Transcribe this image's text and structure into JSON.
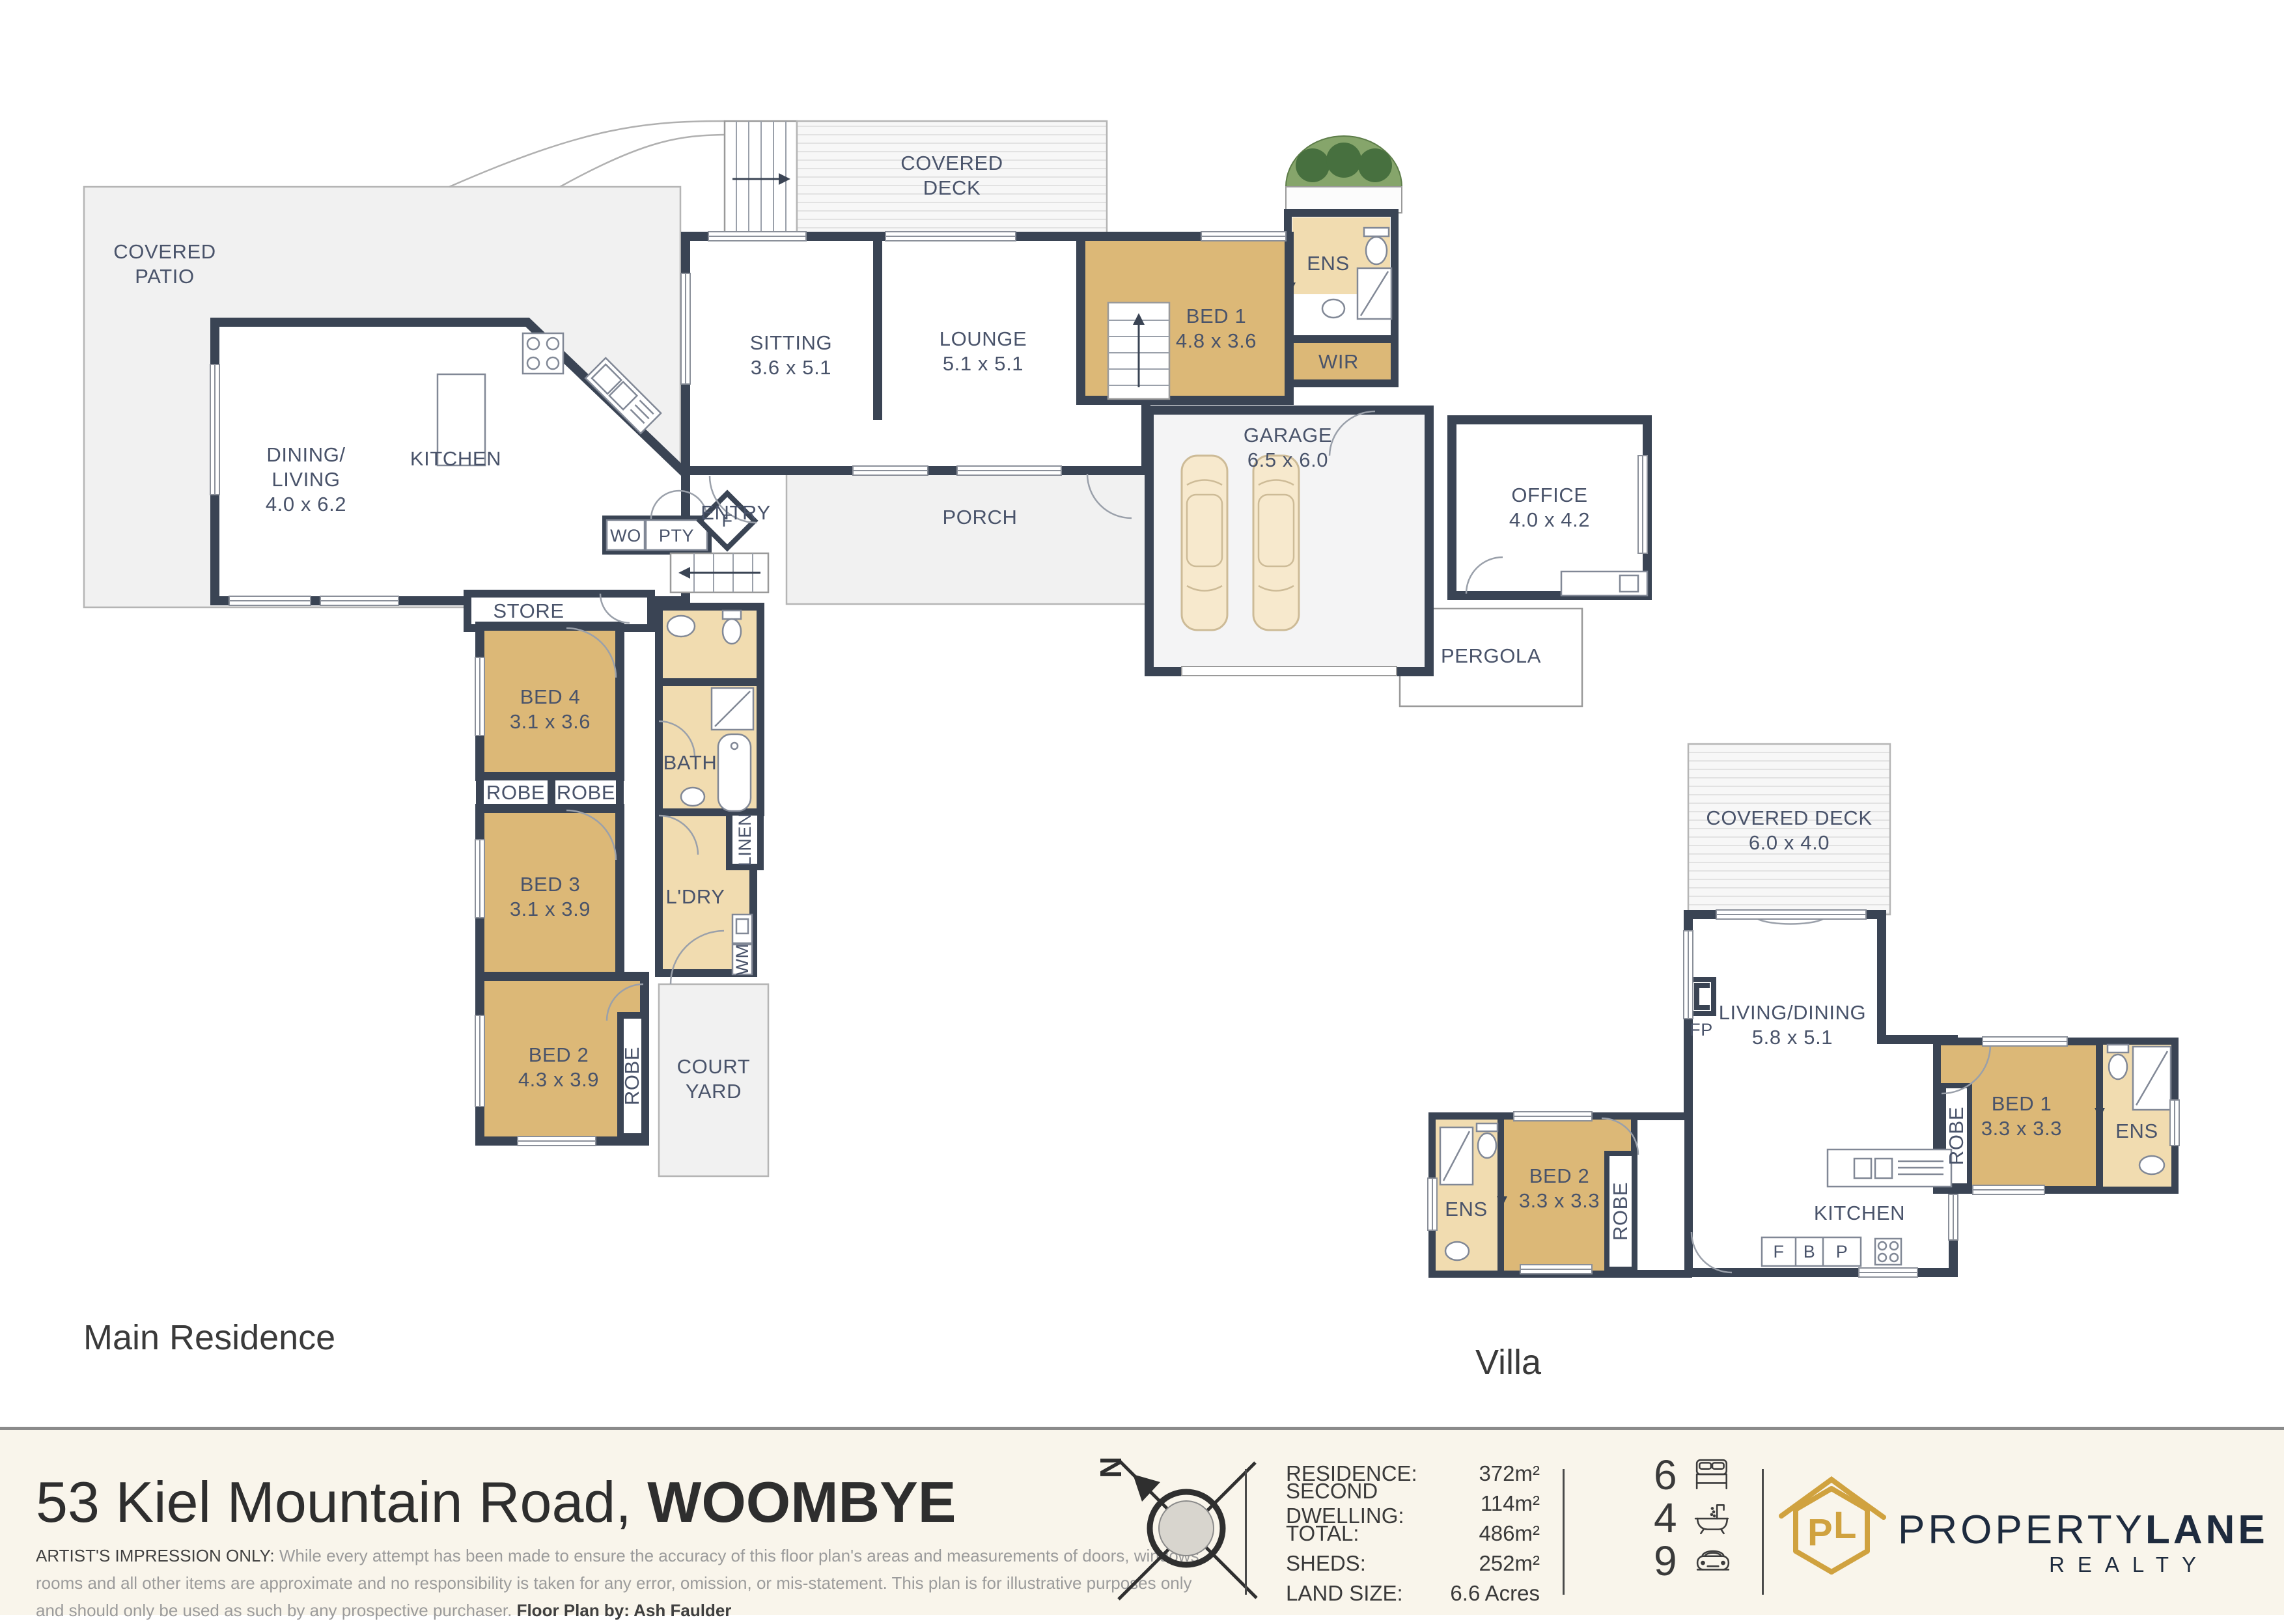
{
  "colors": {
    "wall": "#3a4454",
    "bedroom": "#dcb877",
    "wet_area": "#f1dcb0",
    "outdoor": "#f1f1f1",
    "brand_gold": "#d0a23f",
    "brand_navy": "#1e2b3e",
    "footer_bg": "#f9f5eb"
  },
  "main": {
    "label": "Main Residence",
    "rooms": {
      "patio": {
        "l1": "COVERED",
        "l2": "PATIO"
      },
      "deck": {
        "l1": "COVERED",
        "l2": "DECK"
      },
      "sitting": {
        "name": "SITTING",
        "dims": "3.6 x 5.1"
      },
      "lounge": {
        "name": "LOUNGE",
        "dims": "5.1 x 5.1"
      },
      "bed1": {
        "name": "BED 1",
        "dims": "4.8 x 3.6"
      },
      "ens": {
        "name": "ENS"
      },
      "wir": {
        "name": "WIR"
      },
      "garage": {
        "name": "GARAGE",
        "dims": "6.5 x 6.0"
      },
      "office": {
        "name": "OFFICE",
        "dims": "4.0 x 4.2"
      },
      "pergola": {
        "name": "PERGOLA"
      },
      "dining": {
        "l1": "DINING/",
        "l2": "LIVING",
        "dims": "4.0 x 6.2"
      },
      "kitchen": {
        "name": "KITCHEN"
      },
      "entry": {
        "name": "ENTRY"
      },
      "porch": {
        "name": "PORCH"
      },
      "wo": {
        "name": "WO"
      },
      "pty": {
        "name": "PTY"
      },
      "fridge": {
        "name": "F"
      },
      "store": {
        "name": "STORE"
      },
      "bed4": {
        "name": "BED 4",
        "dims": "3.1 x 3.6"
      },
      "robe_a": {
        "name": "ROBE"
      },
      "robe_b": {
        "name": "ROBE"
      },
      "bed3": {
        "name": "BED 3",
        "dims": "3.1 x 3.9"
      },
      "bath": {
        "name": "BATH"
      },
      "linen": {
        "name": "LINEN"
      },
      "ldry": {
        "name": "L'DRY"
      },
      "wm": {
        "name": "WM"
      },
      "bed2": {
        "name": "BED 2",
        "dims": "4.3 x 3.9"
      },
      "robe_c": {
        "name": "ROBE"
      },
      "courtyard": {
        "l1": "COURT",
        "l2": "YARD"
      }
    }
  },
  "villa": {
    "label": "Villa",
    "rooms": {
      "deck": {
        "name": "COVERED DECK",
        "dims": "6.0 x 4.0"
      },
      "living": {
        "name": "LIVING/DINING",
        "dims": "5.8 x 5.1"
      },
      "fp": {
        "name": "FP"
      },
      "bed1": {
        "name": "BED 1",
        "dims": "3.3 x 3.3"
      },
      "robe1": {
        "name": "ROBE"
      },
      "ens1": {
        "name": "ENS"
      },
      "bed2": {
        "name": "BED 2",
        "dims": "3.3 x 3.3"
      },
      "robe2": {
        "name": "ROBE"
      },
      "ens2": {
        "name": "ENS"
      },
      "kitchen": {
        "name": "KITCHEN"
      },
      "f": {
        "name": "F"
      },
      "b": {
        "name": "B"
      },
      "p": {
        "name": "P"
      }
    }
  },
  "footer": {
    "address_main": "53 Kiel Mountain Road, ",
    "address_bold": "WOOMBYE",
    "disclaimer": {
      "lead": "ARTIST'S IMPRESSION ONLY:",
      "line1_rest": " While every attempt has been made to ensure the accuracy of this floor plan's areas and measurements of doors, windows,",
      "line2": "rooms and all other items are approximate and no responsibility is taken for any error, omission, or mis-statement. This plan is for illustrative purposes only",
      "line3_rest": "and should only be used as such by any prospective purchaser. ",
      "credit": "Floor Plan by: Ash Faulder",
      "compass_n": "N"
    },
    "stats": {
      "r1": {
        "label": "RESIDENCE:",
        "value": "372m²"
      },
      "r2": {
        "label": "SECOND DWELLING:",
        "value": "114m²"
      },
      "r3": {
        "label": "TOTAL:",
        "value": "486m²"
      },
      "r4": {
        "label": "SHEDS:",
        "value": "252m²"
      },
      "r5": {
        "label": "LAND SIZE:",
        "value": "6.6 Acres"
      }
    },
    "counts": {
      "beds": "6",
      "baths": "4",
      "cars": "9"
    },
    "brand": {
      "word_light": "PROPERTY",
      "word_bold": "LANE",
      "tagline": "REALTY",
      "monogram_p": "P",
      "monogram_l": "L"
    }
  }
}
